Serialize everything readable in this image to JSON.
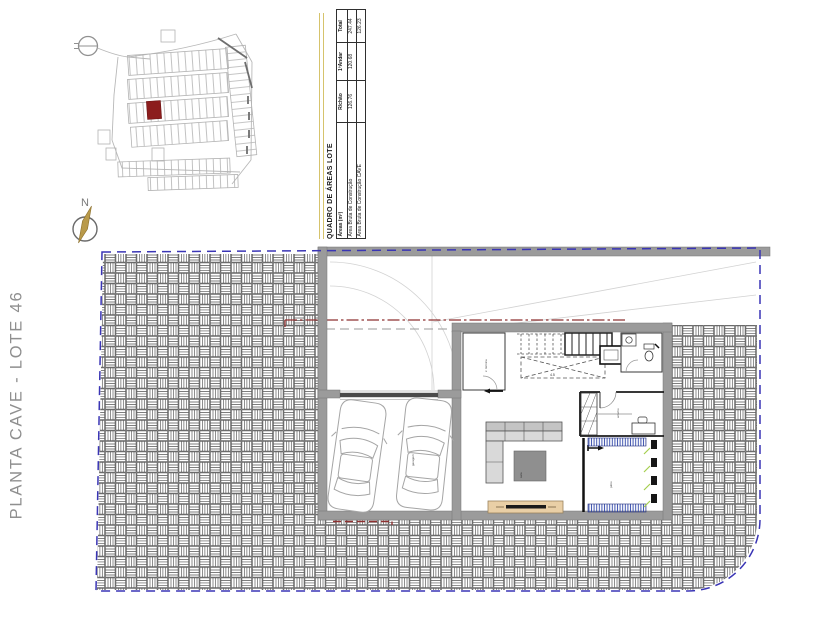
{
  "sheet": {
    "vertical_title": "PLANTA CAVE - LOTE 46"
  },
  "areas_table": {
    "title": "QUADRO DE ÁREAS LOTE",
    "columns": {
      "areas": "Áreas (m²)",
      "rchao": "R/chão",
      "andar1": "1ºAndar",
      "total": "Total"
    },
    "rows": [
      {
        "label": "Área Bruta de Construção",
        "rchao": "126.76",
        "andar1": "120.68",
        "total": "247.44"
      },
      {
        "label": "Área Bruta de Construção CAVE",
        "rchao": "",
        "andar1": "",
        "total": "126.23"
      }
    ],
    "accent_color": "#d6c36c"
  },
  "compass": {
    "north_label": "N"
  },
  "site_plan": {
    "highlight_color": "#8c1d1d",
    "linework_color": "#b3b3b3"
  },
  "plan": {
    "boundary_color": "#3a35b5",
    "setback_line_color": "#8e3030",
    "wall_color": "#9b9b9b",
    "glazing_color": "#a6cf4f",
    "grate_color": "#3a4fae",
    "labels": {
      "garage": "garagem",
      "tech_room": "z. técnica",
      "stairs_value": "4.5",
      "storage": "arrumo",
      "patio": "pátio",
      "living": "sala"
    }
  }
}
